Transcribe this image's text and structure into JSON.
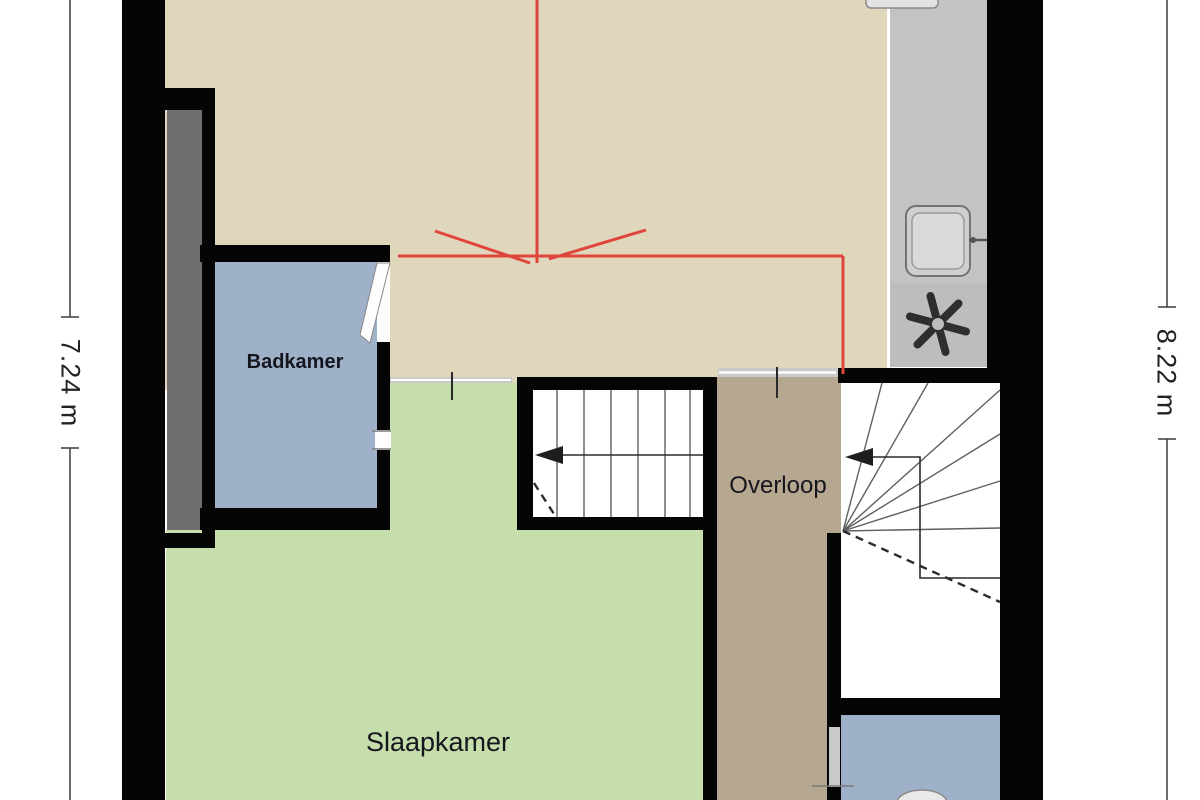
{
  "labels": {
    "badkamer": "Badkamer",
    "slaapkamer": "Slaapkamer",
    "overloop": "Overloop"
  },
  "dimensions": {
    "left": "7.24 m",
    "right": "8.22 m"
  },
  "icons": {
    "sink": "sink-icon",
    "fan": "extractor-fan-icon",
    "stair_arrows": "stair-direction-arrow"
  },
  "colors": {
    "wall": "#050505",
    "attic_floor": "#e0d6bb",
    "bedroom_floor": "#c6deac",
    "bathroom_floor": "#9fb0c9",
    "landing_floor": "#b6a890",
    "counter": "#c3c3c5",
    "counter_dark": "#bdbdbf",
    "chimney": "#6f6f6f",
    "threshold": "#c9c9c9",
    "roof_line_red": "#df453d",
    "dimension_line": "#3c3c3c",
    "stair_line": "#5f5f5f",
    "label_text": "#16161e"
  }
}
